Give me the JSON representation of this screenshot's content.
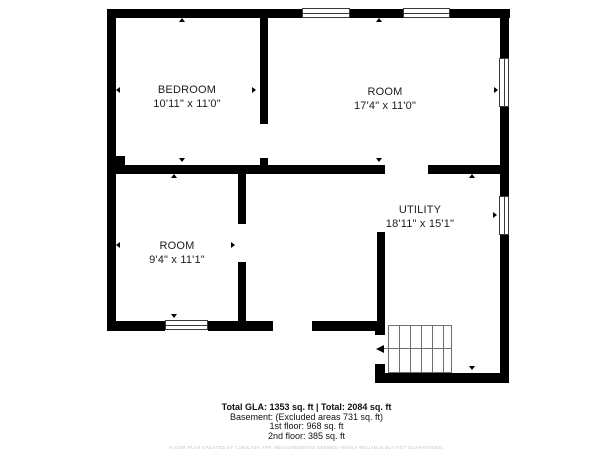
{
  "floor_plan": {
    "rooms": [
      {
        "name": "BEDROOM",
        "dimensions": "10'11\" x 11'0\""
      },
      {
        "name": "ROOM",
        "dimensions": "17'4\" x 11'0\""
      },
      {
        "name": "ROOM",
        "dimensions": "9'4\" x 11'1\""
      },
      {
        "name": "UTILITY",
        "dimensions": "18'11\" x 15'1\""
      }
    ],
    "colors": {
      "walls": "#000000",
      "background": "#ffffff",
      "stair_lines": "#6e6e6e"
    }
  },
  "summary": {
    "total_line": "Total GLA: 1353 sq. ft | Total: 2084 sq. ft",
    "basement_line": "Basement: (Excluded areas 731 sq. ft)",
    "first_floor_line": "1st floor: 968 sq. ft",
    "second_floor_line": "2nd floor: 385 sq. ft",
    "disclaimer": "FLOOR PLAN CREATED BY CUBICASA APP. MEASUREMENTS DEEMED HIGHLY RELIABLE BUT NOT GUARANTEED."
  }
}
